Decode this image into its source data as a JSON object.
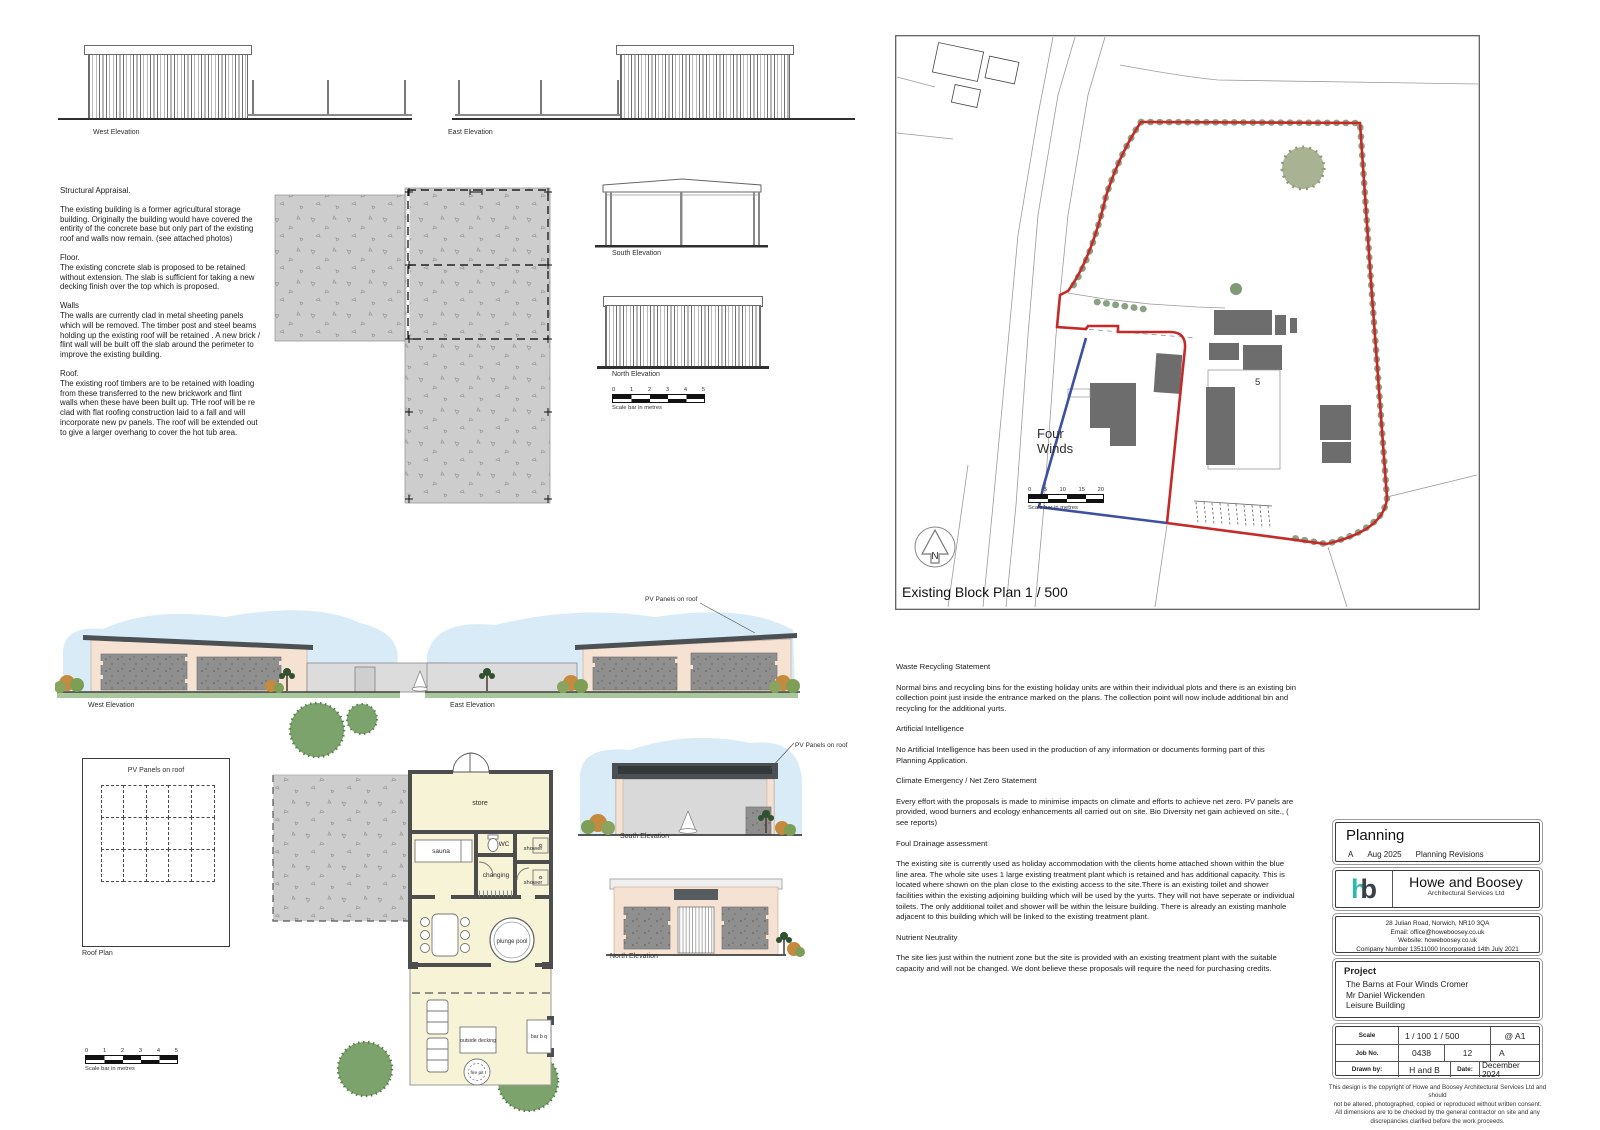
{
  "existing": {
    "west_label": "West Elevation",
    "east_label": "East Elevation",
    "south_label": "South Elevation",
    "north_label": "North Elevation"
  },
  "structural": {
    "title": "Structural Appraisal.",
    "para1": "The existing building is a former agricultural storage building. Originally the building would have covered the entirity of the concrete base but only part of the existing roof and walls now remain. (see attached photos)",
    "floor_title": "Floor.",
    "floor_body": "The existing concrete slab is proposed to be retained without extension. The slab is sufficient for taking a new decking finish over the top which is proposed.",
    "walls_title": "Walls",
    "walls_body": "The walls are currently clad in metal sheeting panels which will be removed. The timber post and steel beams holding up the existing roof will be retained . A new brick / flint wall will be built off the slab around the perimeter to improve the existing building.",
    "roof_title": "Roof.",
    "roof_body": "The existing roof timbers are to be retained with loading from these transferred to the new brickwork and flint walls when these have been built up. THe roof will be re clad with flat roofing construction laid to a fall and will incorporate new pv panels. The roof will be extended out to give a larger overhang to cover the hot tub area."
  },
  "scalebar5": {
    "ticks": [
      "0",
      "1",
      "2",
      "3",
      "4",
      "5"
    ],
    "caption": "Scale bar in metres"
  },
  "block_plan": {
    "title": "Existing Block Plan 1 / 500",
    "site_line1": "Four",
    "site_line2": "Winds",
    "plot_number": "5",
    "north_letter": "N",
    "scale_ticks": [
      "0",
      "5",
      "10",
      "15",
      "20"
    ],
    "scale_caption": "Scale bar in metres",
    "boundary_color": "#c62a28",
    "home_line_color": "#3d4f9f",
    "building_color": "#6d6d6d",
    "hedge_color": "#8aa183"
  },
  "proposed": {
    "west_label": "West Elevation",
    "east_label": "East Elevation",
    "south_label": "South Elevation",
    "north_label": "North Elevation",
    "pv_label": "PV Panels on roof",
    "roof_plan_title": "Roof Plan",
    "rooms": {
      "store": "store",
      "sauna": "sauna",
      "wc": "WC",
      "shower1": "shower",
      "changing": "changing",
      "shower2": "shower",
      "plunge": "plunge pool",
      "decking": "outside decking",
      "barbq": "bar b q",
      "firepit": "fire pit"
    }
  },
  "statements": [
    {
      "heading": "Waste Recycling Statement",
      "body": "Normal bins and recycling bins for the existing holiday units are within their individual plots and there is an existing bin collection point just inside the entrance marked on the plans. The collection point will now include additional bin and recycling for the additional yurts."
    },
    {
      "heading": "Artificial Intelligence",
      "body": "No Artificial Intelligence has been used in the production of any information or documents forming part of this Planning Application."
    },
    {
      "heading": "Climate Emergency / Net Zero Statement",
      "body": "Every effort with the proposals is made to minimise impacts on climate and efforts to achieve net zero. PV panels are provided, wood burners and ecology enhancements all carried out on site. Bio Diversity net gain achieved on site., ( see reports)"
    },
    {
      "heading": "Foul Drainage assessment",
      "body": "The existing site is currently used as holiday  accommodation with the clients home attached shown within the blue line area. The whole site uses 1 large existing treatment plant which is retained and has additional capacity. This is located where shown on the plan close to the existing access to the site.There is an existing toilet and shower facilities within the existing adjoining building which will be used by the yurts. They will not have seperate or individual toilets. The only additional toilet and shower will be within the leisure building. There is already an existing manhole adjacent to this building which will be linked to the existing treatment plant."
    },
    {
      "heading": "Nutrient Neutrality",
      "body": "The site lies just within the nutrient zone but the site is provided with an existing treatment plant with the suitable capacity and will not be changed.  We dont believe these proposals will require the need for purchasing credits."
    }
  ],
  "titleblock": {
    "stage": "Planning",
    "rev_letter": "A",
    "rev_date": "Aug 2025",
    "rev_desc": "Planning Revisions",
    "logo_h": "h",
    "logo_b": "b",
    "company": "Howe and Boosey",
    "company_sub": "Architectural Services Ltd",
    "address1": "28 Julian Road, Norwich, NR10 3QA",
    "address2": "Email: office@howeboosey.co.uk",
    "address3": "Website: howeboosey.co.uk",
    "address4": "Company Number 13511000 Incorporated 14th July 2021",
    "project_label": "Project",
    "project1": "The Barns at Four Winds Cromer",
    "project2": "Mr Daniel Wickenden",
    "project3": "Leisure Building",
    "scale_label": "Scale",
    "scale_value": "1 / 100  1 / 500",
    "sheet_size": "@  A1",
    "job_label": "Job No.",
    "job_number": "0438",
    "drawing_number": "12",
    "revision": "A",
    "drawn_label": "Drawn by:",
    "drawn_value": "H and B",
    "date_label": "Date:",
    "date_value": "December 2024",
    "disclaimer1": "This design is the copyright of Howe and Boosey Architectural Services Ltd and should",
    "disclaimer2": "not be altered, photographed, copied or reproduced without written consent.",
    "disclaimer3": "All dimensions are to be checked by the general contractor on site and any",
    "disclaimer4": "discrepancies clarified before the work proceeds."
  }
}
